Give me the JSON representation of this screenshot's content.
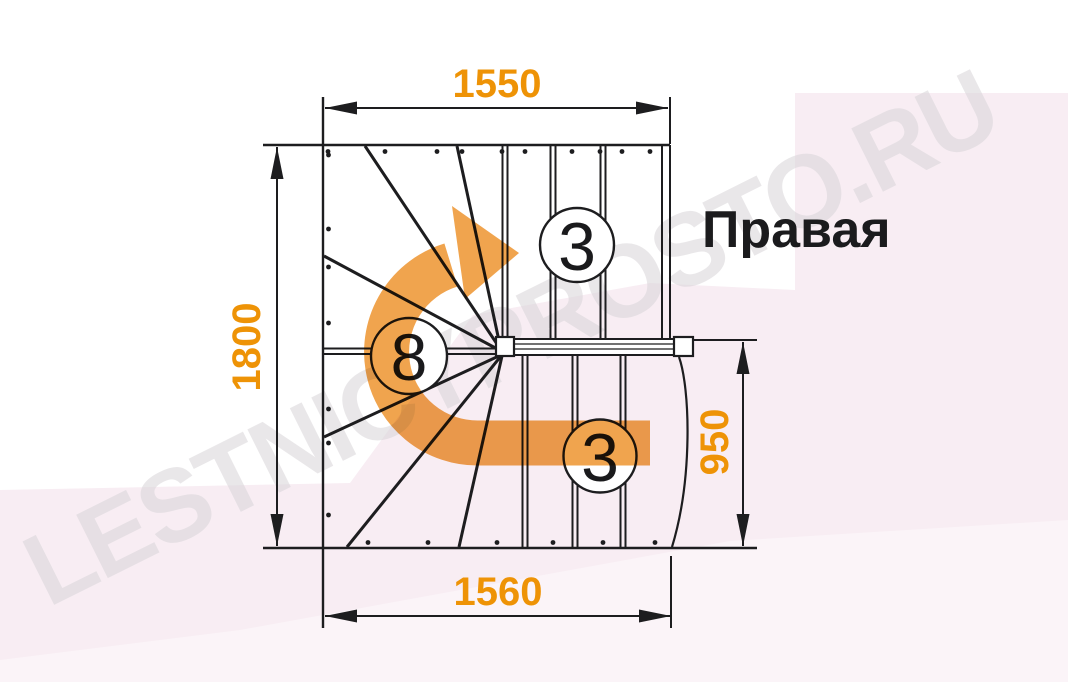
{
  "diagram": {
    "title": "Правая",
    "watermark": "LESTNICYPROSTO.RU",
    "dimensions": {
      "top": "1550",
      "left": "1800",
      "right": "950",
      "bottom": "1560"
    },
    "step_counts": {
      "upper_flight": "3",
      "winders": "8",
      "lower_flight": "3"
    },
    "colors": {
      "dimension": "#ee9306",
      "arrow": "#f0a44e",
      "line": "#1d1d1f",
      "background_pink": "#f8edf3",
      "background_pink_light": "#fbf4f8"
    }
  }
}
